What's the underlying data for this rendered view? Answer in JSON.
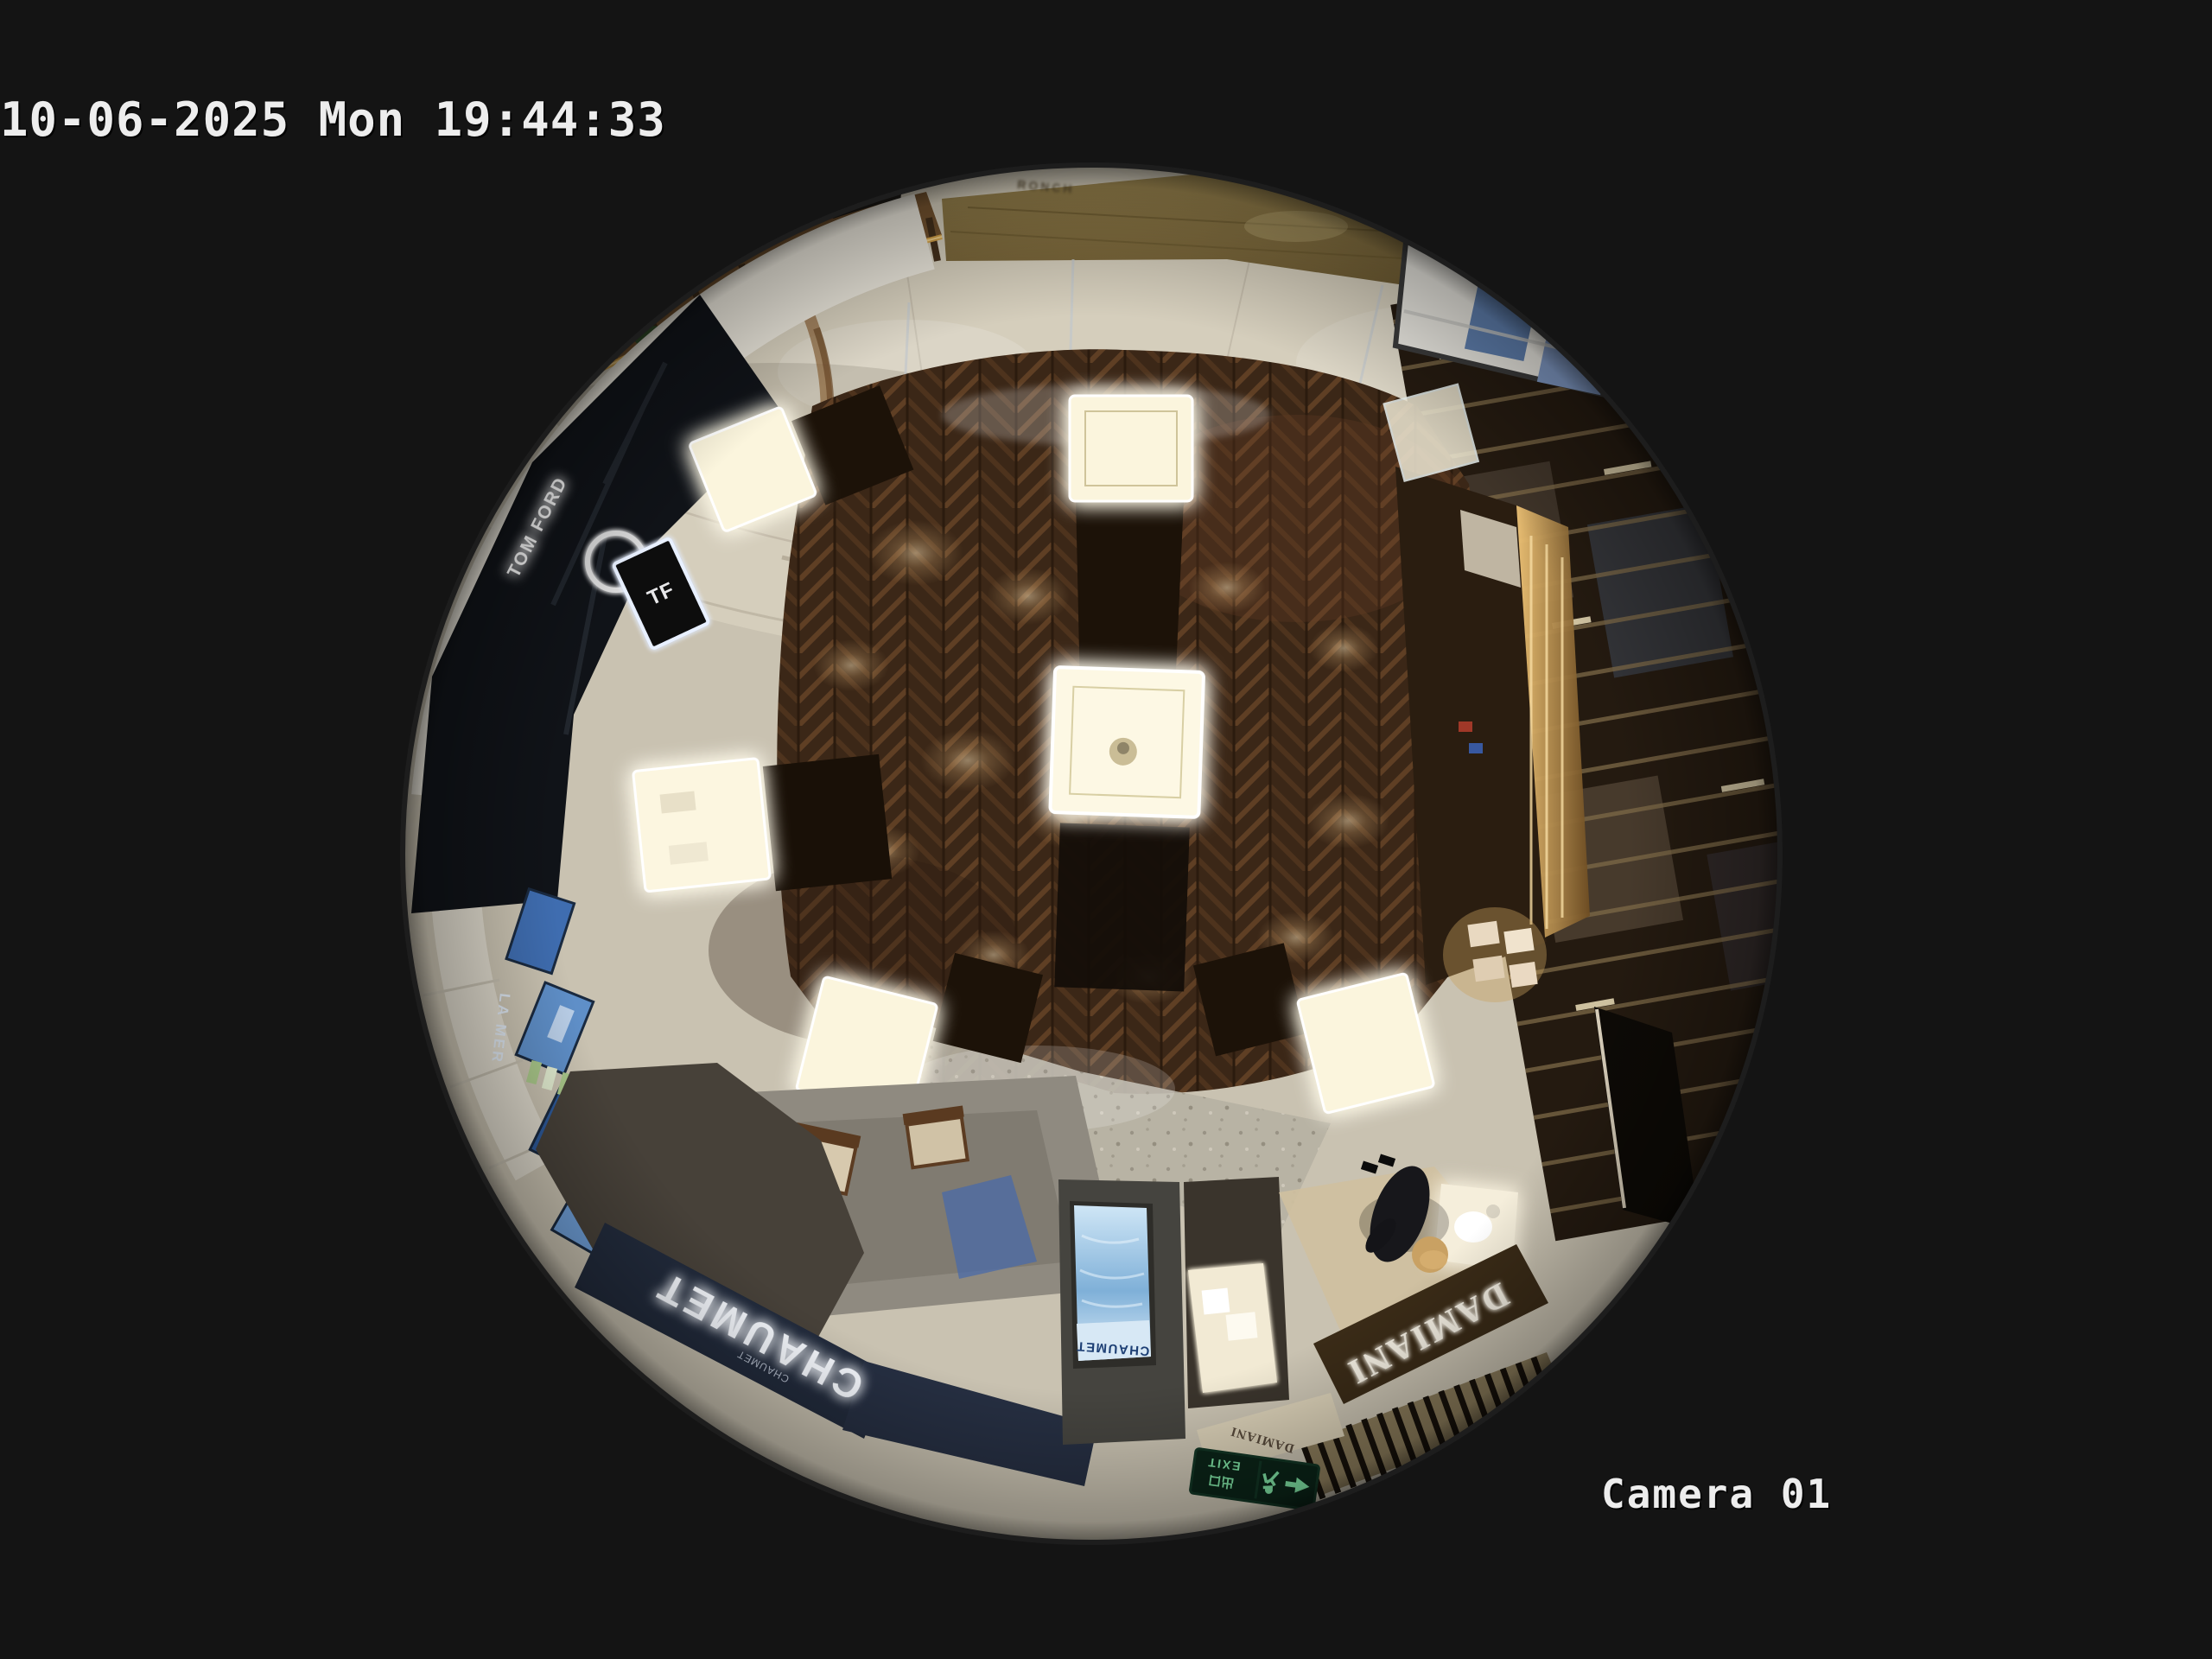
{
  "osd": {
    "timestamp": "10-06-2025 Mon 19:44:33",
    "camera_label": "Camera 01"
  },
  "signs": {
    "chaumet_fascia": "CHAUMET",
    "chaumet_fascia_small": "CHAUMET",
    "chaumet_screen": "CHAUMET",
    "damiani_fascia": "DAMIANI",
    "damiani_small": "DAMIANI",
    "tom_ford": "TOM FORD",
    "tf_monogram": "TF",
    "la_mer": "LA MER",
    "gold_wall": "RONCH",
    "exit_en": "EXIT",
    "exit_cn": "出口"
  },
  "colors": {
    "background": "#141414",
    "osd_text": "#ededed",
    "marble": "#c9c2b1",
    "wood_floor": "#3b2717",
    "chaumet_navy": "#222b3c",
    "damiani_brown": "#3a2b17",
    "exit_green": "#7fe2a4",
    "screen_blue": "#7fb0d8",
    "case_glow": "#fdf6e0",
    "gold_trim": "#d8a448"
  }
}
